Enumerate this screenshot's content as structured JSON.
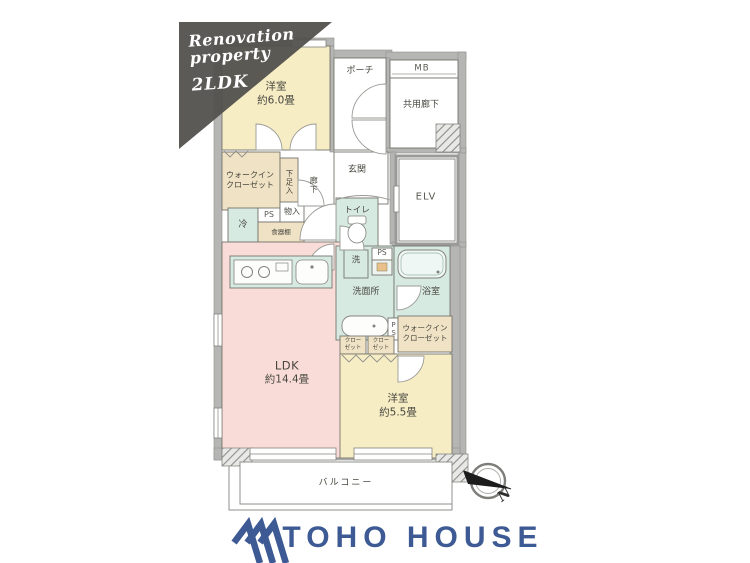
{
  "banner": {
    "line1": "Renovation",
    "line2": "property",
    "line3": "2LDK"
  },
  "plan": {
    "bedroom_top": {
      "name": "洋室",
      "area": "約6.0畳"
    },
    "porch": {
      "label": "ポーチ"
    },
    "meter_box": {
      "label": "MB"
    },
    "common_corridor": {
      "label": "共用廊下"
    },
    "wic_left": {
      "line1": "ウォークイン",
      "line2": "クローゼット"
    },
    "shoe_cabinet": {
      "label": "下足入"
    },
    "hallway": {
      "label": "廊下"
    },
    "entrance": {
      "label": "玄関"
    },
    "elevator": {
      "label": "ELV"
    },
    "fridge": {
      "label": "冷"
    },
    "ps_kitchen": {
      "label": "PS"
    },
    "storage": {
      "label": "物入"
    },
    "cupboard": {
      "label": "食器棚"
    },
    "toilet": {
      "label": "トイレ"
    },
    "washer": {
      "label": "洗"
    },
    "ps_washroom": {
      "label": "PS"
    },
    "washroom": {
      "label": "洗面所"
    },
    "bathroom": {
      "label": "浴室"
    },
    "ps_side": {
      "label": "PS"
    },
    "wic_right": {
      "line1": "ウォークイン",
      "line2": "クローゼット"
    },
    "closet_a": {
      "line1": "クロー",
      "line2": "ゼット"
    },
    "closet_b": {
      "line1": "クロー",
      "line2": "ゼット"
    },
    "ldk": {
      "name": "LDK",
      "area": "約14.4畳"
    },
    "bedroom_bottom": {
      "name": "洋室",
      "area": "約5.5畳"
    },
    "balcony": {
      "label": "バルコニー"
    }
  },
  "compass": {
    "north": "N"
  },
  "footer": {
    "brand": "TOHO HOUSE"
  },
  "colors": {
    "room_yellow": "#f7edc5",
    "room_beige": "#f0e2c4",
    "room_pink": "#f9dcd8",
    "room_green": "#d7eae2",
    "wall_gray": "#b5b5b3",
    "banner_gray": "#52514d",
    "brand_blue": "#3d5a94"
  }
}
